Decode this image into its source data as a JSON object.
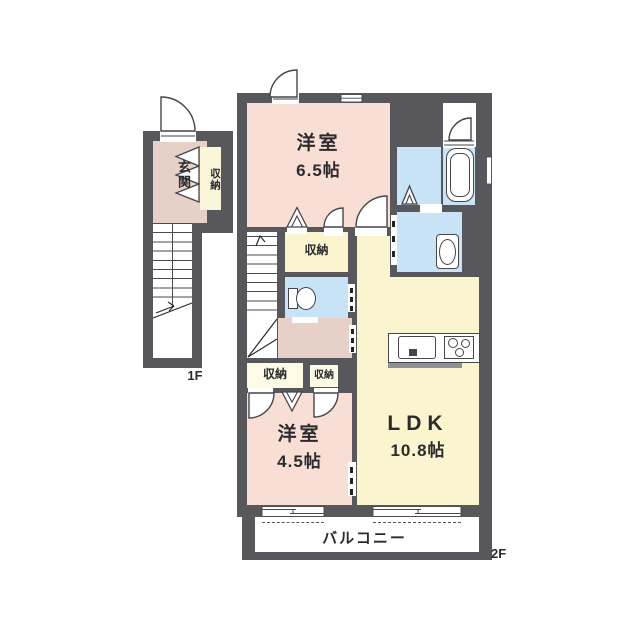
{
  "palette": {
    "wall": "#57575c",
    "bedroom_pink": "#f8ded4",
    "hall_pink": "#e6d0c8",
    "ldk_yellow": "#faf4cf",
    "closet_cream": "#fdfae6",
    "wet_blue": "#c8e3f5",
    "background": "#ffffff",
    "line": "#45454a"
  },
  "floor_1f": {
    "floor_label": "1F",
    "entrance_label": "玄関",
    "closet_label": "収納"
  },
  "floor_2f": {
    "floor_label": "2F",
    "bedroom_top": {
      "name": "洋室",
      "size": "6.5帖"
    },
    "closet_mid": "収納",
    "closet_bottom_left": "収納",
    "closet_bottom_right": "収納",
    "bedroom_bottom": {
      "name": "洋室",
      "size": "4.5帖"
    },
    "ldk": {
      "name": "LDK",
      "size": "10.8帖"
    },
    "balcony_label": "バルコニー"
  }
}
